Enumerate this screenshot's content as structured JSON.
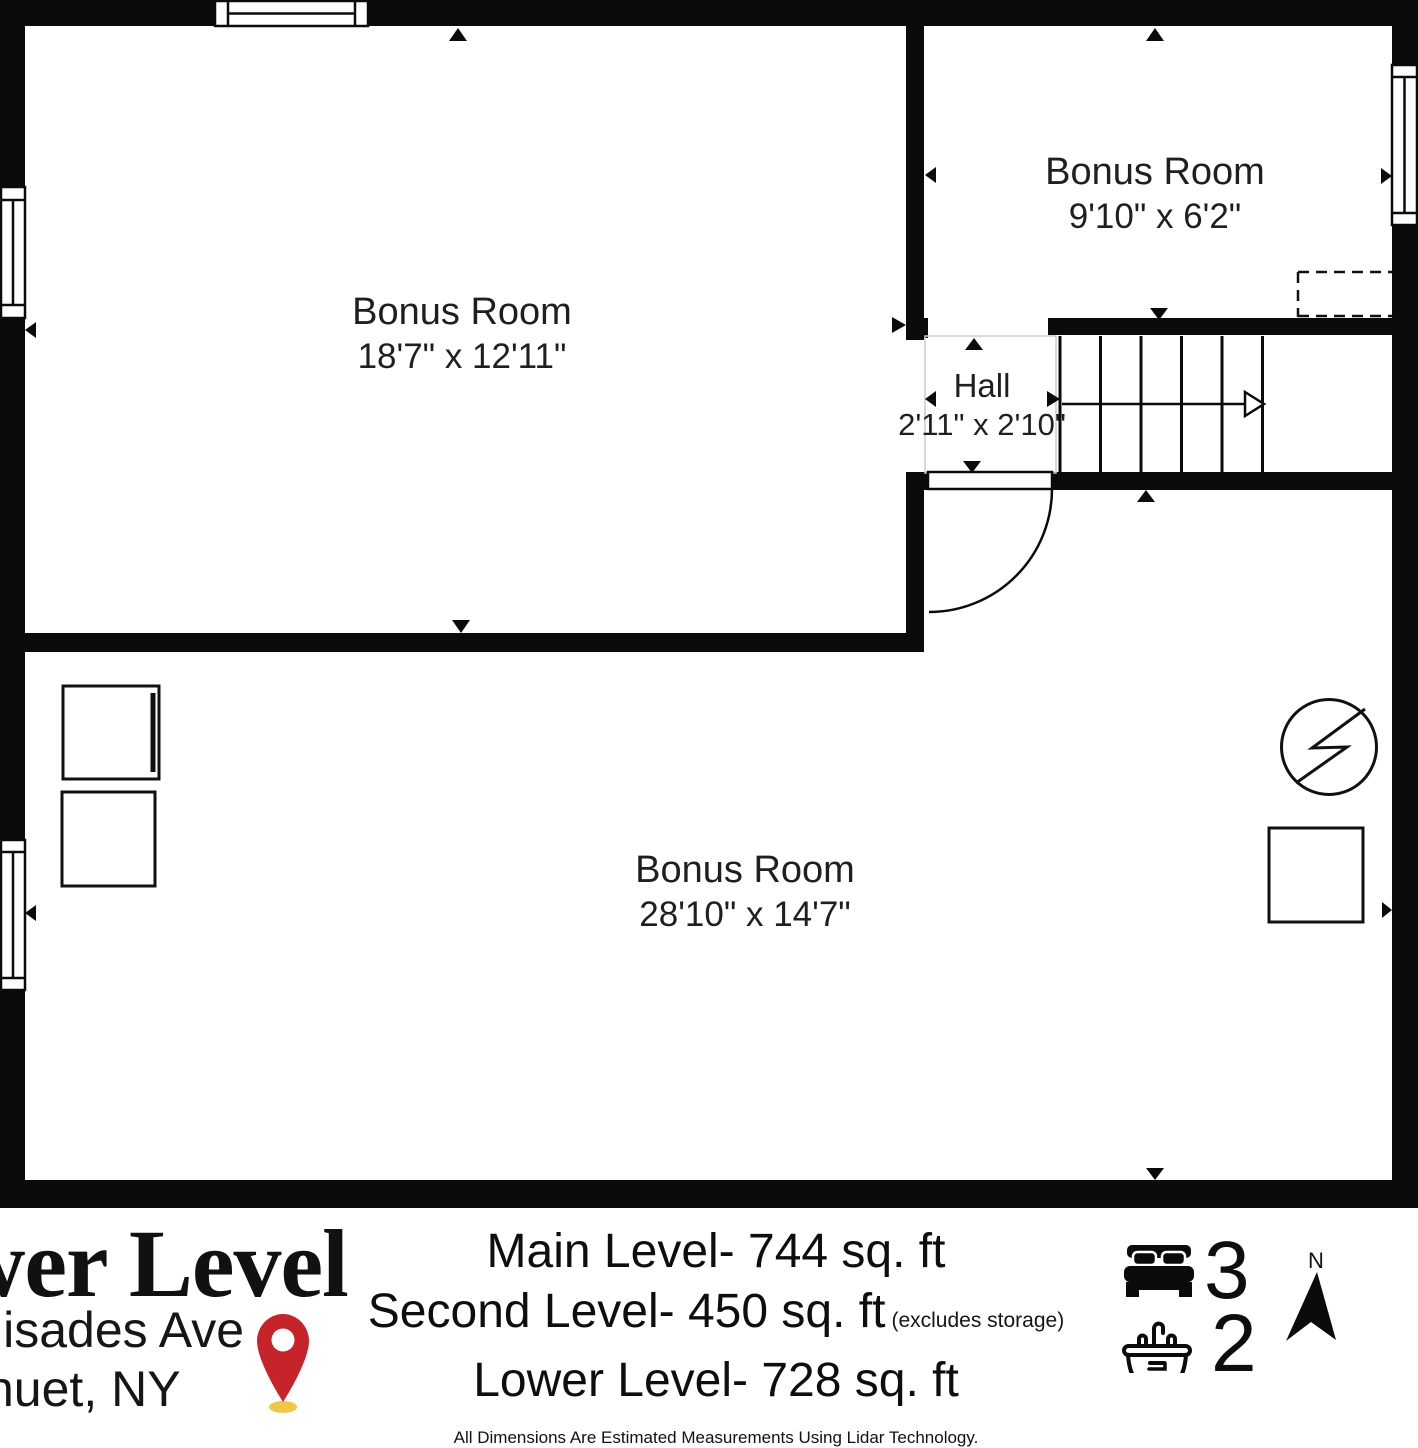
{
  "colors": {
    "wall": "#0b0b0b",
    "text": "#1c1c1c",
    "hall_outline": "#cccccc",
    "pin_red": "#c5242b",
    "pin_shadow": "#f0c64a"
  },
  "rooms": [
    {
      "name": "Bonus Room",
      "dims": "18'7\" x 12'11\""
    },
    {
      "name": "Bonus Room",
      "dims": "9'10\" x 6'2\""
    },
    {
      "name": "Hall",
      "dims": "2'11\" x 2'10\""
    },
    {
      "name": "Bonus Room",
      "dims": "28'10\" x 14'7\""
    }
  ],
  "footer": {
    "title": "wer Level",
    "address_line1": "lisades Ave",
    "address_line2": "nuet, NY",
    "area_lines": [
      {
        "text": "Main Level- 744 sq. ft",
        "note": ""
      },
      {
        "text": "Second Level- 450 sq. ft",
        "note": "(excludes storage)"
      },
      {
        "text": "Lower Level- 728 sq. ft",
        "note": ""
      }
    ],
    "disclaimer": "All Dimensions Are Estimated Measurements Using Lidar Technology.",
    "bedrooms": "3",
    "bathrooms": "2",
    "compass_label": "N"
  }
}
